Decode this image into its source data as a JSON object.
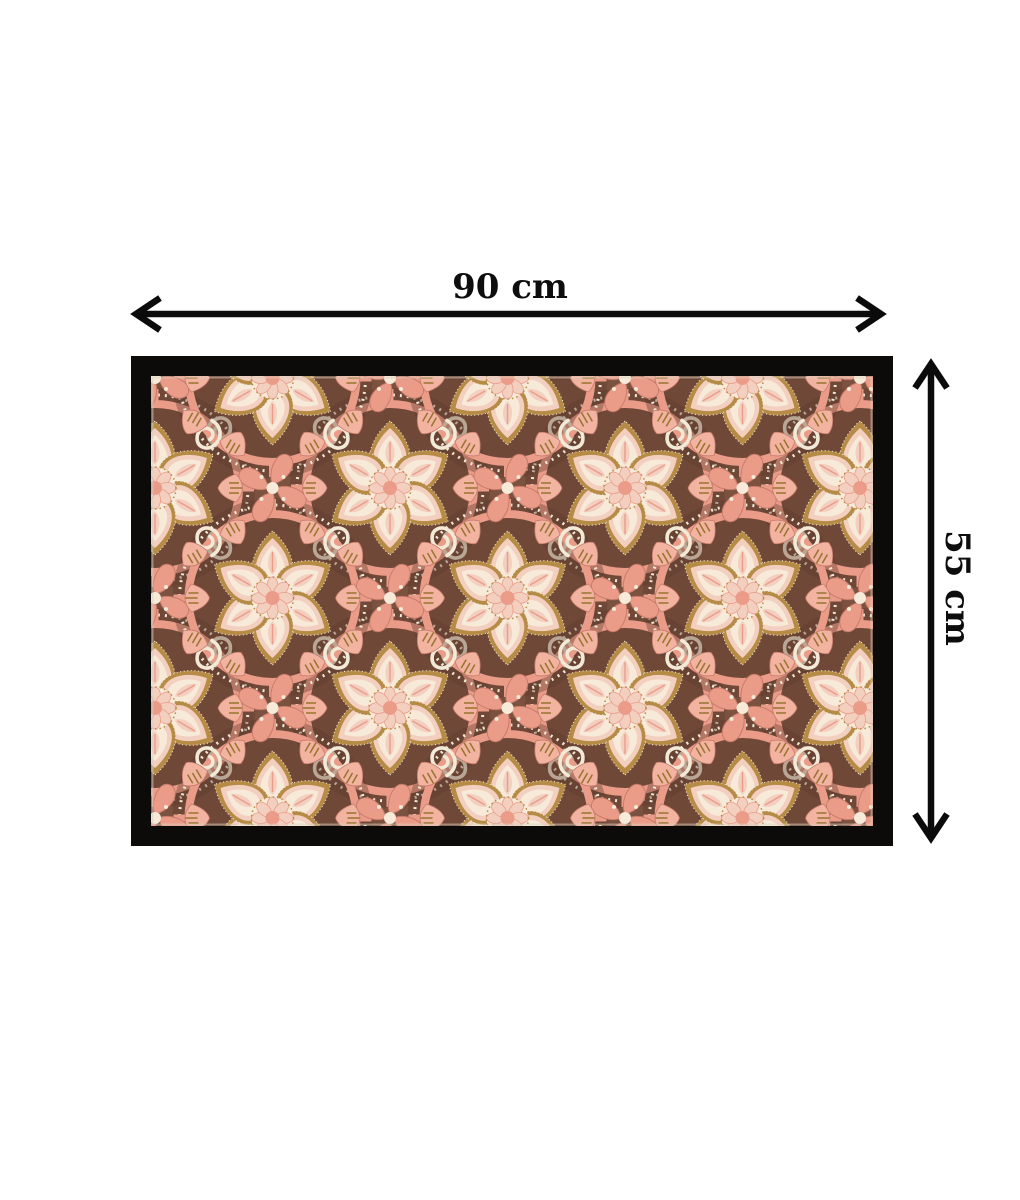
{
  "scene": {
    "type": "product-dimension-diagram",
    "background": "#ffffff"
  },
  "dimensions": {
    "width_label": "90 cm",
    "height_label": "55 cm"
  },
  "mat": {
    "motif": "floral-medallion-damask",
    "shape": "rectangle",
    "frame_color": "#0d0b09"
  },
  "colors": {
    "frame": "#0d0b09",
    "brown": "#7b5140",
    "brownDark": "#5d392b",
    "pink": "#eb9c89",
    "pinkDark": "#c77b69",
    "fanPink": "#f2b3a0",
    "petalPink": "#f3cfc0",
    "cream": "#f7ead9",
    "cream2": "#f2e9d6",
    "gold": "#b68b46",
    "goldDark": "#97742f",
    "arrow": "#0b0b0b",
    "pageBg": "#ffffff"
  }
}
